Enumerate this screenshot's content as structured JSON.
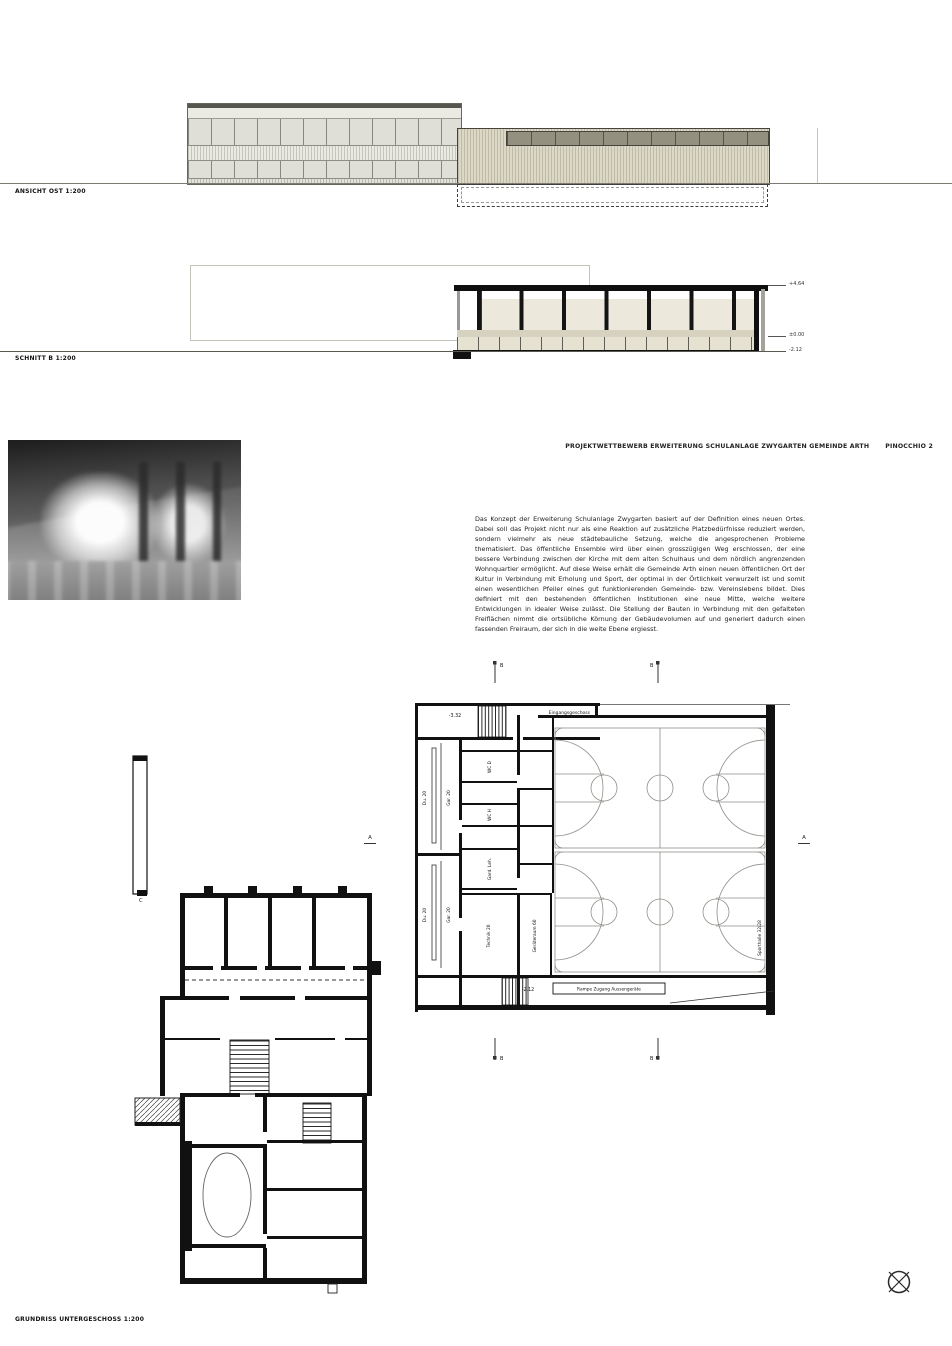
{
  "header": {
    "project_title": "PROJEKTWETTBEWERB ERWEITERUNG SCHULANLAGE ZWYGARTEN GEMEINDE ARTH",
    "motto": "PINOCCHIO 2"
  },
  "drawings": {
    "elevation_label": "ANSICHT OST 1:200",
    "section_label": "SCHNITT B 1:200",
    "plan_label": "GRUNDRISS UNTERGESCHOSS 1:200"
  },
  "description": "Das Konzept der Erweiterung Schulanlage Zwygarten basiert auf der Definition eines neuen Ortes. Dabei soll das Projekt nicht nur als eine Reaktion auf zusätzliche Platzbedürfnisse reduziert werden, sondern vielmehr als neue städtebauliche Setzung, welche die angesprochenen Probleme thematisiert. Das öffentliche Ensemble wird über einen grosszügigen Weg erschlossen, der eine bessere Verbindung zwischen der Kirche mit dem alten Schulhaus und dem nördlich angrenzenden Wohnquartier ermöglicht. Auf diese Weise erhält die Gemeinde Arth einen neuen öffentlichen Ort der Kultur in Verbindung mit Erholung und Sport, der optimal in der Örtlichkeit verwurzelt ist und somit einen wesentlichen Pfeiler eines gut funktionierenden Gemeinde- bzw. Vereinslebens bildet. Dies definiert mit den bestehenden öffentlichen Institutionen eine neue Mitte, welche weitere Entwicklungen in idealer Weise zulässt. Die Stellung der Bauten in Verbindung mit den gefalteten Freiflächen nimmt die ortsübliche Körnung der Gebäudevolumen auf und generiert dadurch einen fassenden Freiraum, der sich in die weite Ebene ergiesst.",
  "section": {
    "levels": [
      "+4.64",
      "±0.00",
      "-2.12"
    ]
  },
  "gym_plan": {
    "entry_level": "-3.32",
    "entry_label": "Eingangsgeschoss",
    "hall_level": "-2.12",
    "ramp_label": "Rampe Zugang Aussengeräte",
    "rooms": {
      "du1": "Du. 20",
      "gar1": "Gar. 20",
      "du2": "Du. 20",
      "gar2": "Gar. 20",
      "wc_d": "WC D",
      "wc_h": "WC H",
      "gard_leh": "Gard. Leh.",
      "technik": "Technik 20",
      "geraete": "Geräteraum 60",
      "sporthalle": "Sporthalle 32/28"
    },
    "markers": {
      "section_b": "B",
      "section_a": "A"
    }
  },
  "old_plan": {
    "marker_c": "C"
  },
  "colors": {
    "facade_panel": "#dfdfd7",
    "facade_rib": "#d9d5c3",
    "facade_dark_band": "#94907f",
    "section_room": "#ece8dc",
    "section_band": "#d7d1c0",
    "wall_black": "#111111",
    "court_line": "#8f8f89"
  }
}
